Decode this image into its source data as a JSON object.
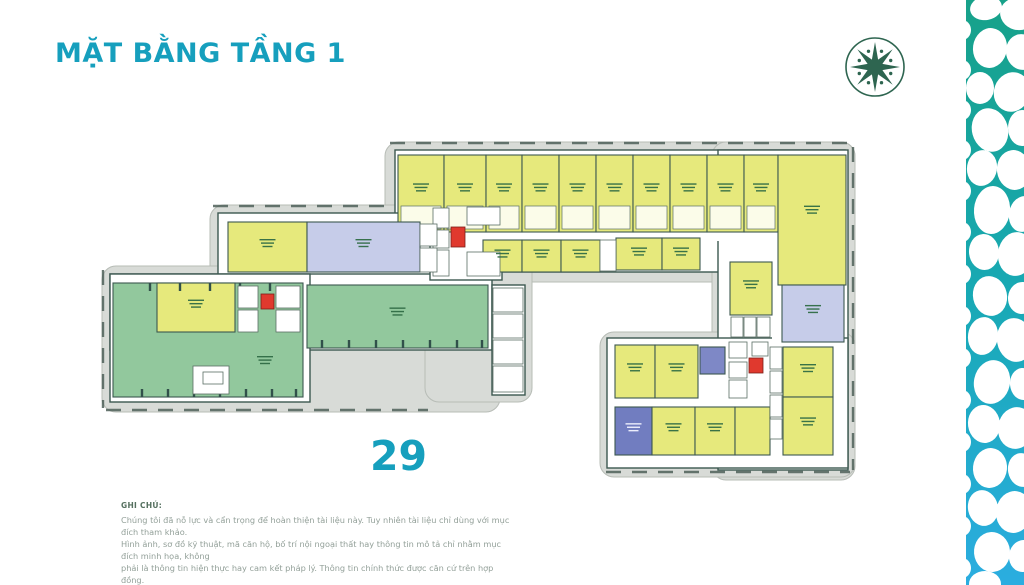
{
  "page": {
    "title": "MẶT BẰNG TẦNG 1",
    "plan_number": "29",
    "accent_color": "#169fbd"
  },
  "logo": {
    "name": "star-emblem",
    "color": "#2e6550"
  },
  "note": {
    "heading": "GHI CHÚ:",
    "lines": [
      "Chúng tôi đã nỗ lực và cẩn trọng để hoàn thiện tài liệu này. Tuy nhiên tài liệu chỉ dùng với mục đích tham khảo.",
      "Hình ảnh, sơ đồ kỹ thuật, mã căn hộ, bố trí nội ngoại thất hay thông tin mô tả chỉ nhằm mục đích minh họa, không",
      "phải là thông tin hiện thực hay cam kết pháp lý. Thông tin chính thức được căn cứ trên hợp đồng."
    ]
  },
  "floorplan": {
    "palette": {
      "sidewalk": "#d8dbd7",
      "sidewalk_border": "#b7bcb6",
      "interior": "#ffffff",
      "wall": "#3c5850",
      "room_stroke": "#5a6e64",
      "y": "#e6e97c",
      "g": "#92c89d",
      "l": "#c6cce9",
      "b": "#7e88c6",
      "d": "#717dc0",
      "red": "#e0392e",
      "label": "#2f6b45",
      "label_light": "#f2f4ff",
      "dash": "#4f615a",
      "tick": "#31504a"
    },
    "sidewalks": [
      [
        385,
        142,
        470,
        140
      ],
      [
        712,
        142,
        143,
        338
      ],
      [
        600,
        332,
        255,
        145
      ],
      [
        210,
        205,
        228,
        80
      ],
      [
        102,
        266,
        398,
        146
      ],
      [
        425,
        198,
        107,
        204
      ]
    ],
    "dashes": [
      [
        390,
        143,
        848,
        143
      ],
      [
        853,
        147,
        853,
        470
      ],
      [
        606,
        472,
        850,
        472
      ],
      [
        213,
        206,
        384,
        206
      ],
      [
        103,
        270,
        103,
        408
      ],
      [
        106,
        410,
        428,
        410
      ]
    ],
    "interiors": [
      [
        395,
        150,
        450,
        122
      ],
      [
        718,
        150,
        130,
        320
      ],
      [
        607,
        338,
        241,
        130
      ],
      [
        218,
        213,
        219,
        67
      ],
      [
        110,
        274,
        382,
        76
      ],
      [
        110,
        274,
        200,
        128
      ],
      [
        430,
        205,
        72,
        75
      ],
      [
        492,
        285,
        33,
        110
      ]
    ],
    "corridors": [
      [
        398,
        232,
        380,
        9
      ],
      [
        772,
        287,
        11,
        170
      ],
      [
        615,
        398,
        155,
        10
      ]
    ],
    "units": [
      {
        "x": 398,
        "y": 155,
        "w": 46,
        "h": 77,
        "c": "y",
        "lb": 1,
        "sub": 1
      },
      {
        "x": 444,
        "y": 155,
        "w": 42,
        "h": 77,
        "c": "y",
        "lb": 1,
        "sub": 1
      },
      {
        "x": 486,
        "y": 155,
        "w": 36,
        "h": 77,
        "c": "y",
        "lb": 1,
        "sub": 1
      },
      {
        "x": 522,
        "y": 155,
        "w": 37,
        "h": 77,
        "c": "y",
        "lb": 1,
        "sub": 1
      },
      {
        "x": 559,
        "y": 155,
        "w": 37,
        "h": 77,
        "c": "y",
        "lb": 1,
        "sub": 1
      },
      {
        "x": 596,
        "y": 155,
        "w": 37,
        "h": 77,
        "c": "y",
        "lb": 1,
        "sub": 1
      },
      {
        "x": 633,
        "y": 155,
        "w": 37,
        "h": 77,
        "c": "y",
        "lb": 1,
        "sub": 1
      },
      {
        "x": 670,
        "y": 155,
        "w": 37,
        "h": 77,
        "c": "y",
        "lb": 1,
        "sub": 1
      },
      {
        "x": 707,
        "y": 155,
        "w": 37,
        "h": 77,
        "c": "y",
        "lb": 1,
        "sub": 1
      },
      {
        "x": 744,
        "y": 155,
        "w": 34,
        "h": 77,
        "c": "y",
        "lb": 1,
        "sub": 1
      },
      {
        "x": 778,
        "y": 155,
        "w": 68,
        "h": 130,
        "c": "y",
        "lb": 1
      },
      {
        "x": 483,
        "y": 240,
        "w": 39,
        "h": 32,
        "c": "y",
        "lb": 1
      },
      {
        "x": 522,
        "y": 240,
        "w": 39,
        "h": 32,
        "c": "y",
        "lb": 1
      },
      {
        "x": 561,
        "y": 240,
        "w": 39,
        "h": 32,
        "c": "y",
        "lb": 1
      },
      {
        "x": 616,
        "y": 238,
        "w": 46,
        "h": 32,
        "c": "y",
        "lb": 1
      },
      {
        "x": 662,
        "y": 238,
        "w": 38,
        "h": 32,
        "c": "y",
        "lb": 1
      },
      {
        "x": 730,
        "y": 262,
        "w": 42,
        "h": 53,
        "c": "y",
        "lb": 1
      },
      {
        "x": 782,
        "y": 285,
        "w": 62,
        "h": 57,
        "c": "l",
        "lb": 1
      },
      {
        "x": 783,
        "y": 347,
        "w": 50,
        "h": 50,
        "c": "y",
        "lb": 1
      },
      {
        "x": 783,
        "y": 397,
        "w": 50,
        "h": 58,
        "c": "y",
        "lb": 1
      },
      {
        "x": 615,
        "y": 345,
        "w": 40,
        "h": 53,
        "c": "y",
        "lb": 1
      },
      {
        "x": 655,
        "y": 345,
        "w": 43,
        "h": 53,
        "c": "y",
        "lb": 1
      },
      {
        "x": 700,
        "y": 347,
        "w": 25,
        "h": 27,
        "c": "b"
      },
      {
        "x": 615,
        "y": 407,
        "w": 37,
        "h": 48,
        "c": "d",
        "lbw": 1
      },
      {
        "x": 652,
        "y": 407,
        "w": 43,
        "h": 48,
        "c": "y",
        "lb": 1
      },
      {
        "x": 695,
        "y": 407,
        "w": 40,
        "h": 48,
        "c": "y",
        "lb": 1
      },
      {
        "x": 735,
        "y": 407,
        "w": 35,
        "h": 48,
        "c": "y"
      },
      {
        "x": 228,
        "y": 222,
        "w": 79,
        "h": 50,
        "c": "y",
        "lb": 1
      },
      {
        "x": 307,
        "y": 222,
        "w": 113,
        "h": 50,
        "c": "l",
        "lb": 1
      },
      {
        "x": 113,
        "y": 283,
        "w": 190,
        "h": 114,
        "c": "g",
        "lb": 1,
        "lx": 265,
        "ly": 360
      },
      {
        "x": 157,
        "y": 283,
        "w": 78,
        "h": 49,
        "c": "y",
        "lb": 1
      },
      {
        "x": 307,
        "y": 285,
        "w": 181,
        "h": 63,
        "c": "g",
        "lb": 1
      }
    ],
    "ticks": [
      [
        142,
        389,
        142,
        397
      ],
      [
        168,
        389,
        168,
        397
      ],
      [
        194,
        389,
        194,
        397
      ],
      [
        220,
        389,
        220,
        397
      ],
      [
        246,
        389,
        246,
        397
      ],
      [
        272,
        389,
        272,
        397
      ],
      [
        296,
        389,
        296,
        397
      ],
      [
        322,
        340,
        322,
        348
      ],
      [
        349,
        340,
        349,
        348
      ],
      [
        376,
        340,
        376,
        348
      ],
      [
        403,
        340,
        403,
        348
      ],
      [
        430,
        340,
        430,
        348
      ],
      [
        457,
        340,
        457,
        348
      ],
      [
        482,
        340,
        482,
        348
      ],
      [
        150,
        283,
        150,
        291
      ],
      [
        180,
        283,
        180,
        291
      ],
      [
        210,
        283,
        210,
        291
      ],
      [
        240,
        283,
        240,
        291
      ],
      [
        270,
        283,
        270,
        291
      ]
    ],
    "rooms": [
      [
        433,
        208,
        16,
        20
      ],
      [
        433,
        230,
        16,
        18
      ],
      [
        433,
        250,
        16,
        26
      ],
      [
        467,
        207,
        33,
        18
      ],
      [
        467,
        252,
        33,
        24
      ],
      [
        238,
        286,
        20,
        22
      ],
      [
        238,
        310,
        20,
        22
      ],
      [
        276,
        286,
        24,
        22
      ],
      [
        276,
        310,
        24,
        22
      ],
      [
        729,
        342,
        18,
        16
      ],
      [
        729,
        362,
        18,
        16
      ],
      [
        729,
        380,
        18,
        18
      ],
      [
        752,
        342,
        16,
        14
      ],
      [
        770,
        347,
        12,
        22
      ],
      [
        770,
        371,
        12,
        22
      ],
      [
        770,
        395,
        12,
        22
      ],
      [
        770,
        419,
        12,
        20
      ],
      [
        731,
        317,
        12,
        20
      ],
      [
        744,
        317,
        12,
        20
      ],
      [
        757,
        317,
        13,
        20
      ],
      [
        493,
        288,
        30,
        24
      ],
      [
        493,
        314,
        30,
        24
      ],
      [
        493,
        340,
        30,
        24
      ],
      [
        493,
        366,
        30,
        26
      ],
      [
        420,
        224,
        17,
        22
      ],
      [
        420,
        248,
        17,
        24
      ],
      [
        600,
        240,
        16,
        31
      ],
      [
        193,
        366,
        36,
        28
      ],
      [
        203,
        372,
        20,
        12
      ]
    ],
    "elevators": [
      [
        451,
        227,
        14,
        20
      ],
      [
        261,
        294,
        13,
        15
      ],
      [
        749,
        358,
        14,
        15
      ]
    ]
  },
  "side_pattern": {
    "top_color": "#17a189",
    "mid_color": "#18a9b4",
    "bottom_color": "#2bade0",
    "strip": [
      966,
      0,
      58,
      585
    ],
    "cells": [
      [
        986,
        8,
        16,
        12,
        -10
      ],
      [
        1018,
        14,
        18,
        16,
        15
      ],
      [
        990,
        48,
        17,
        20,
        8
      ],
      [
        1022,
        52,
        16,
        18,
        -12
      ],
      [
        980,
        88,
        14,
        16,
        0
      ],
      [
        1012,
        92,
        18,
        20,
        20
      ],
      [
        990,
        130,
        18,
        22,
        -15
      ],
      [
        1022,
        128,
        14,
        18,
        0
      ],
      [
        982,
        168,
        15,
        18,
        10
      ],
      [
        1014,
        170,
        17,
        20,
        -8
      ],
      [
        992,
        210,
        18,
        24,
        5
      ],
      [
        1023,
        214,
        14,
        18,
        12
      ],
      [
        984,
        252,
        15,
        18,
        -5
      ],
      [
        1016,
        254,
        18,
        22,
        8
      ],
      [
        990,
        296,
        17,
        20,
        -12
      ],
      [
        1022,
        298,
        14,
        16,
        5
      ],
      [
        983,
        336,
        15,
        19,
        8
      ],
      [
        1015,
        340,
        18,
        22,
        -10
      ],
      [
        992,
        382,
        18,
        22,
        12
      ],
      [
        1023,
        384,
        13,
        16,
        -5
      ],
      [
        984,
        424,
        16,
        19,
        -8
      ],
      [
        1016,
        428,
        18,
        21,
        10
      ],
      [
        990,
        468,
        17,
        20,
        6
      ],
      [
        1022,
        470,
        14,
        17,
        -10
      ],
      [
        983,
        508,
        15,
        18,
        -12
      ],
      [
        1014,
        512,
        18,
        21,
        8
      ],
      [
        992,
        552,
        18,
        20,
        -5
      ],
      [
        1023,
        556,
        14,
        16,
        10
      ],
      [
        985,
        584,
        16,
        13,
        0
      ],
      [
        962,
        30,
        9,
        10,
        0
      ],
      [
        962,
        70,
        9,
        10,
        0
      ],
      [
        962,
        110,
        9,
        10,
        0
      ],
      [
        962,
        150,
        9,
        10,
        0
      ],
      [
        962,
        191,
        9,
        10,
        0
      ],
      [
        962,
        232,
        9,
        10,
        0
      ],
      [
        962,
        274,
        9,
        10,
        0
      ],
      [
        962,
        316,
        9,
        10,
        0
      ],
      [
        962,
        358,
        9,
        10,
        0
      ],
      [
        962,
        400,
        9,
        10,
        0
      ],
      [
        962,
        442,
        9,
        10,
        0
      ],
      [
        962,
        484,
        9,
        10,
        0
      ],
      [
        962,
        526,
        9,
        10,
        0
      ],
      [
        962,
        568,
        9,
        10,
        0
      ]
    ]
  }
}
